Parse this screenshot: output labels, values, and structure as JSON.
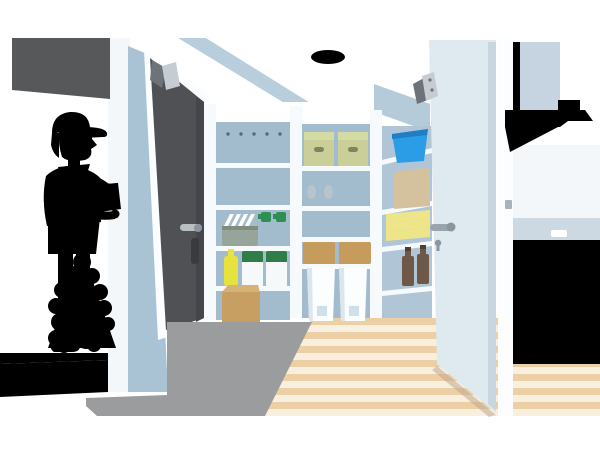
{
  "scene": {
    "type": "flat-illustration",
    "width": 600,
    "height": 450,
    "background": "#ffffff"
  },
  "objects": [
    "delivery-worker",
    "parcel-box",
    "entrance-door",
    "door-closer",
    "entrance-step",
    "shrub",
    "tiled-entry-floor",
    "wood-floor",
    "pantry-shelving",
    "file-boxes",
    "food-containers",
    "dish-basket",
    "spray-bottles",
    "detergent-jugs",
    "yellow-bottle",
    "cardboard-box",
    "green-storage-boxes",
    "rice-bags",
    "lidded-boxes",
    "woven-baskets",
    "waste-bins",
    "blue-bucket",
    "tote-bag",
    "towel-stack",
    "brown-bottles",
    "open-white-door",
    "door-lever",
    "keyhole",
    "door-hinge",
    "ceiling-light",
    "range-hood",
    "kitchen-counter",
    "built-in-oven",
    "drawer-handles"
  ],
  "colors": {
    "bg": "#ffffff",
    "awning": "#57585a",
    "pillar": "#f3f7fa",
    "wall_blue": "#a9c3d4",
    "ceiling_blue": "#b9cedd",
    "trim_white": "#ffffff",
    "entry_door": "#505155",
    "entry_door_shade": "#44464b",
    "door_frame": "#fbfdfe",
    "handle_metal": "#b9bec2",
    "handle_dark": "#3a3b3f",
    "closer_light": "#c6cdd2",
    "closer_dark": "#6d7378",
    "pantry_back": "#a3bccd",
    "pantry_back_light": "#b0c6d6",
    "shelf_white": "#f7fafc",
    "soffit_blue": "#b6cbda",
    "file_box": "#fbfdfe",
    "file_dot": "#5a6a74",
    "container_white": "#f6f9fa",
    "container_line": "#ccd6dc",
    "basket_gray": "#96a49a",
    "basket_rim": "#7e8c80",
    "plate_white": "#ffffff",
    "spray_green": "#2e8f52",
    "jug_green": "#2f7d49",
    "bottle_yellow": "#e6e33e",
    "green_box": "#c9cf97",
    "green_box_lid": "#d4daa4",
    "green_box_slot": "#7e8560",
    "bag_white": "#f8fafb",
    "bag_window": "#b7c4cd",
    "rattan": "#c59c5c",
    "rattan_line": "#9e7b43",
    "bin_white": "#fcfdfe",
    "bin_shade": "#dce7ed",
    "bin_label": "#cfe0ea",
    "bucket_blue": "#2b9ce6",
    "bucket_dark": "#1f7fc4",
    "tote_beige": "#d4c29e",
    "tote_line": "#b9a67e",
    "towel_yellow": "#ede588",
    "towel_line": "#d8cf6b",
    "beer_brown": "#6e5847",
    "beer_cap": "#4e3f33",
    "cardboard": "#c89f62",
    "cardboard_top": "#d7b277",
    "parcel_line": "#a5824c",
    "tile": "#9b9c9e",
    "grout": "#d9d9d9",
    "step_top": "#b9babc",
    "step_face": "#cbccce",
    "step_line": "#77787a",
    "wood_light": "#f8efdf",
    "wood_dark": "#eccfa5",
    "white_door": "#dfe9f0",
    "white_door_edge": "#c9d6e0",
    "door_bevel": "#f6fafc",
    "door_metal": "#99a4ad",
    "door_metal_dark": "#8a959e",
    "door_shadow": "#b9a489",
    "hinge_gray": "#aab3ba",
    "hood": "#c5d4e0",
    "hood_light": "#d2dee8",
    "hood_shade": "#b3c6d4",
    "hood_under": "#46525c",
    "hood_wall_shade": "#a2b7c6",
    "backsplash": "#cdd9e2",
    "counter_top": "#3e4852",
    "cabinet": "#a9c0d1",
    "oven_panel": "#8ba6b8",
    "oven_frame": "#6b8496",
    "oven_glass": "#17191c",
    "oven_btn": "#2a3338",
    "oven_handle": "#333a40",
    "drawer_handle": "#f8fbfd",
    "kitchen_seam": "#c2d2de",
    "wall_soft": "#f3f7fa",
    "light_yellow": "#f8f1a3",
    "light_core": "#f3e87f",
    "skin": "#f8d8c3",
    "blush": "#f3bca9",
    "hair": "#4a3b32",
    "cap": "#4b76bb",
    "cap_brim": "#3a5f9e",
    "jacket": "#6286c6",
    "jacket_dark": "#5b7fc0",
    "collar": "#46689f",
    "pants": "#4a70b6",
    "pants_line": "#3a5b96",
    "shoe": "#46474b",
    "shoe2": "#55565a",
    "parcel": "#c9a263",
    "parcel_top": "#d9b87a",
    "parcel_tape": "#e0c690",
    "leaf1": "#bcd43a",
    "leaf2": "#8cc63f",
    "leaf3": "#57a345",
    "leaf4": "#cfe04a",
    "leaf_dark": "#3e7d35",
    "face_line": "#8c6f5e"
  }
}
